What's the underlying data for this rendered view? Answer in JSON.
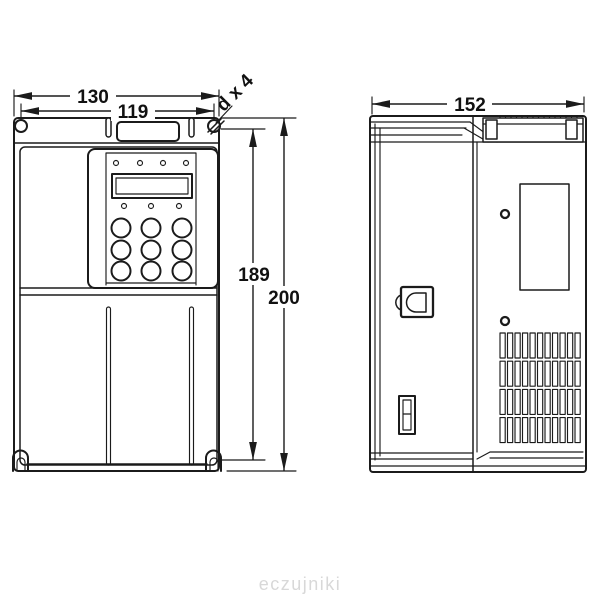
{
  "drawing": {
    "type": "technical-dimension-drawing",
    "subject": "frequency-inverter-enclosure",
    "line_color": "#1b1b1b",
    "background": "#ffffff"
  },
  "dimensions": {
    "front_width_outer": "130",
    "front_width_mounting": "119",
    "mounting_hole_note": "d x 4",
    "front_height_mounting": "189",
    "front_height_outer": "200",
    "side_depth": "152"
  },
  "watermark": {
    "text": "eczujniki",
    "color": "#d8d8d8"
  }
}
